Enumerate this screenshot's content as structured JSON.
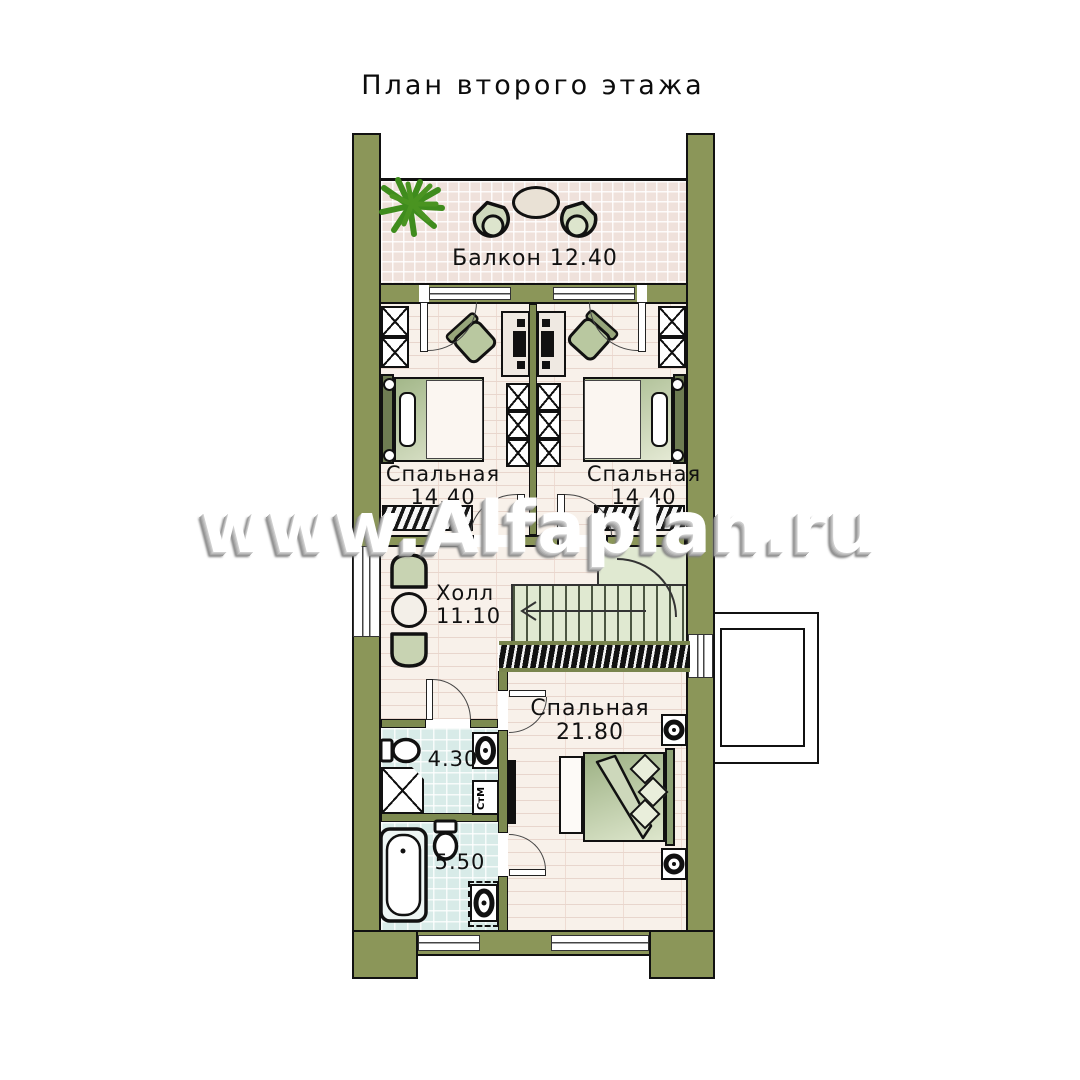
{
  "title": "План второго этажа",
  "watermark": "www.Alfaplan.ru",
  "rooms": {
    "balcony": {
      "name": "Балкон",
      "area": "12.40"
    },
    "bedroom_left": {
      "name": "Спальная",
      "area": "14.40"
    },
    "bedroom_right": {
      "name": "Спальная",
      "area": "14.40"
    },
    "hall": {
      "name": "Холл",
      "area": "11.10"
    },
    "master_bedroom": {
      "name": "Спальная",
      "area": "21.80"
    },
    "wc": {
      "area": "4.30"
    },
    "bathroom": {
      "area": "5.50"
    }
  },
  "labels": {
    "washing_machine": "СтМ"
  },
  "colors": {
    "wall": "#8b9659",
    "plant": "#4a9421",
    "floor": "#f8f1ea",
    "balcony_tile": "#efe1db",
    "bath_tile": "#d8ebe8",
    "stairs": "#e0e9d1",
    "furniture": "#aabd8e",
    "outline": "#111111"
  }
}
